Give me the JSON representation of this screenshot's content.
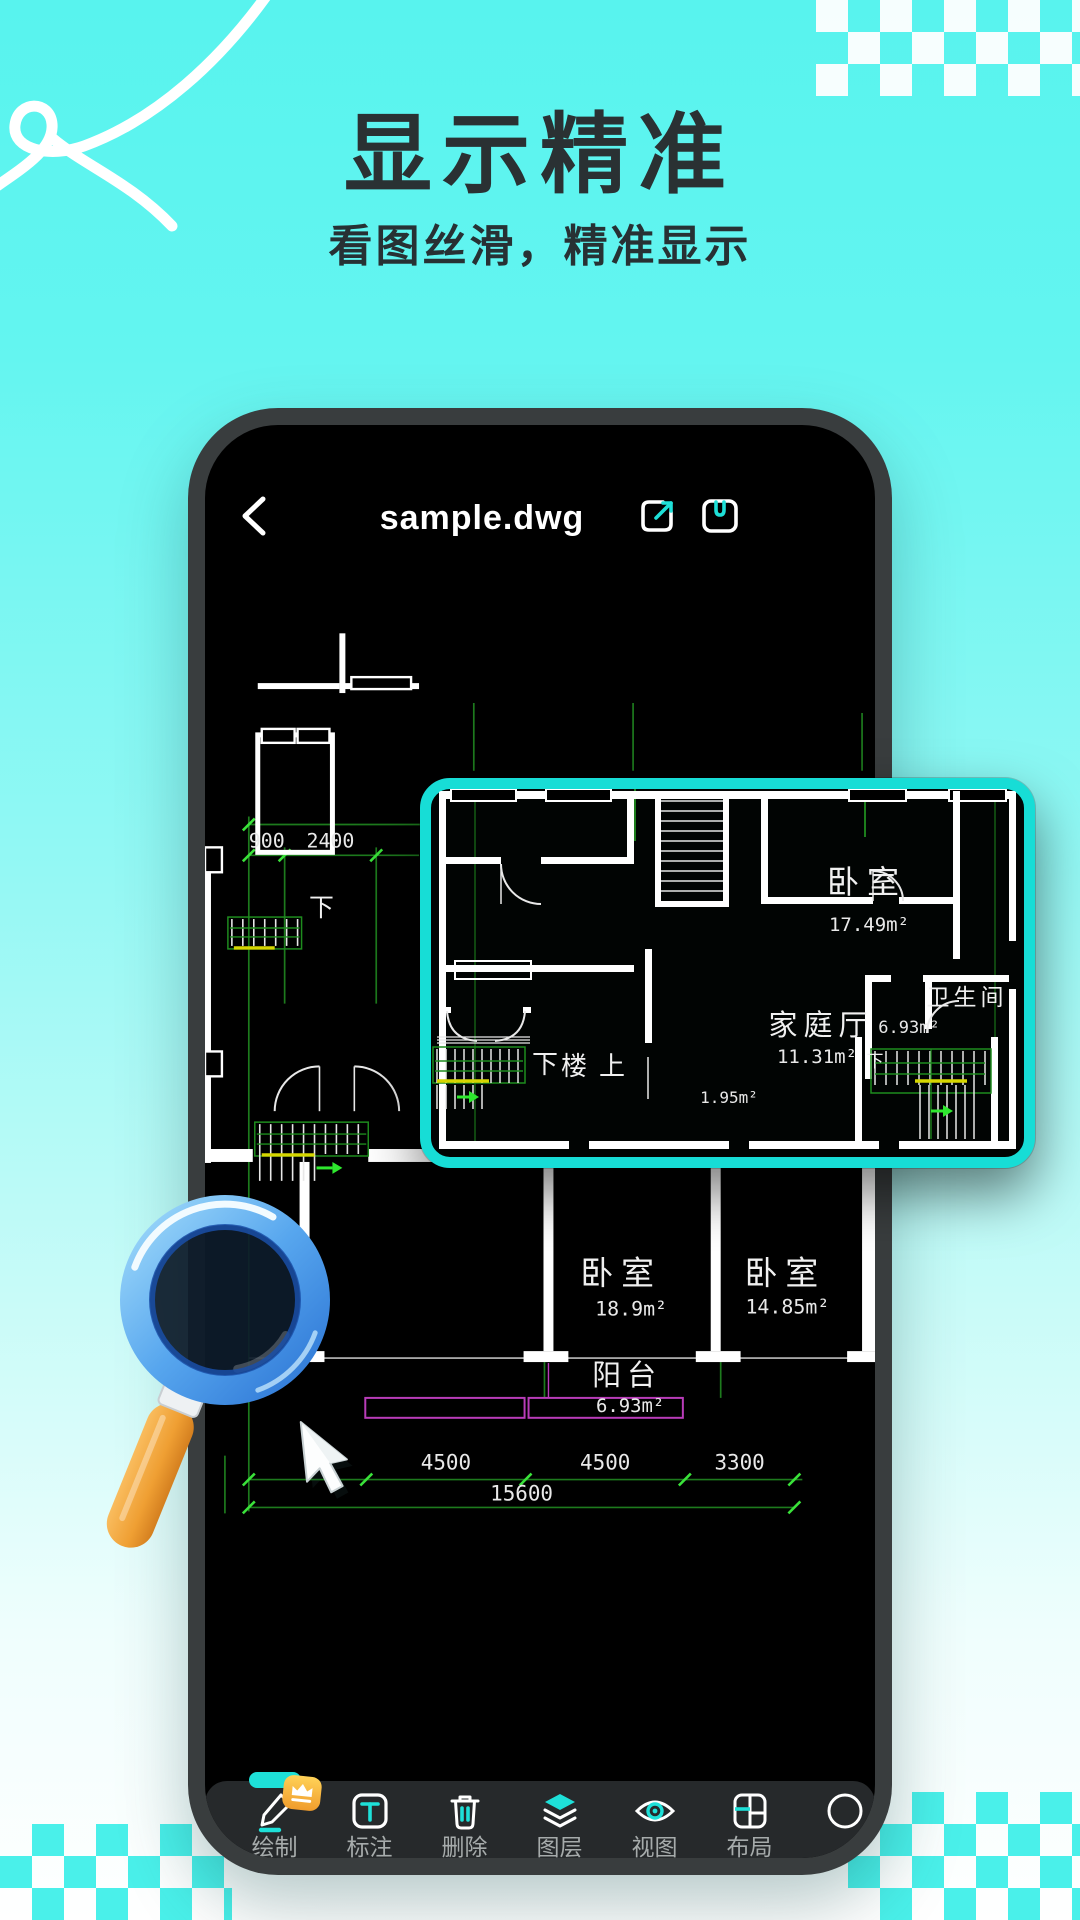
{
  "hero": {
    "title": "显示精准",
    "subtitle": "看图丝滑，精准显示"
  },
  "viewer": {
    "filename": "sample.dwg",
    "toolbar": [
      {
        "label": "绘制",
        "icon": "pen-icon",
        "active": true,
        "badge": "crown"
      },
      {
        "label": "标注",
        "icon": "text-annotation-icon"
      },
      {
        "label": "删除",
        "icon": "trash-icon"
      },
      {
        "label": "图层",
        "icon": "layers-icon"
      },
      {
        "label": "视图",
        "icon": "eye-icon"
      },
      {
        "label": "布局",
        "icon": "layout-icon"
      }
    ]
  },
  "floor_plan": {
    "dims_top": [
      "900",
      "2400"
    ],
    "dims_bottom": [
      "4500",
      "4500",
      "3300"
    ],
    "dim_total": "15600",
    "rooms": [
      {
        "name": "卧室",
        "area": "18.9m²"
      },
      {
        "name": "卧室",
        "area": "14.85m²"
      },
      {
        "name": "阳台",
        "area": "6.93m²"
      }
    ],
    "stair_label": "下"
  },
  "magnified": {
    "rooms": [
      {
        "name": "卧室",
        "area": "17.49m²"
      },
      {
        "name": "家庭厅",
        "area": "11.31m²"
      },
      {
        "name": "卫生间",
        "area": "6.93m²"
      }
    ],
    "labels": {
      "down": "下",
      "up": "楼上",
      "area_small": "1.95m²",
      "stair_down": "下"
    }
  },
  "colors": {
    "accent_cyan": "#1ee0d8",
    "callout_border": "#17ddd6",
    "cad_green": "#1e8c1e",
    "cad_bright_green": "#3ae23a",
    "cad_yellow": "#d6d600",
    "cad_purple": "#b93cb9",
    "badge_gold": "#f09c2c",
    "bg_cyan": "#58f3ee"
  }
}
